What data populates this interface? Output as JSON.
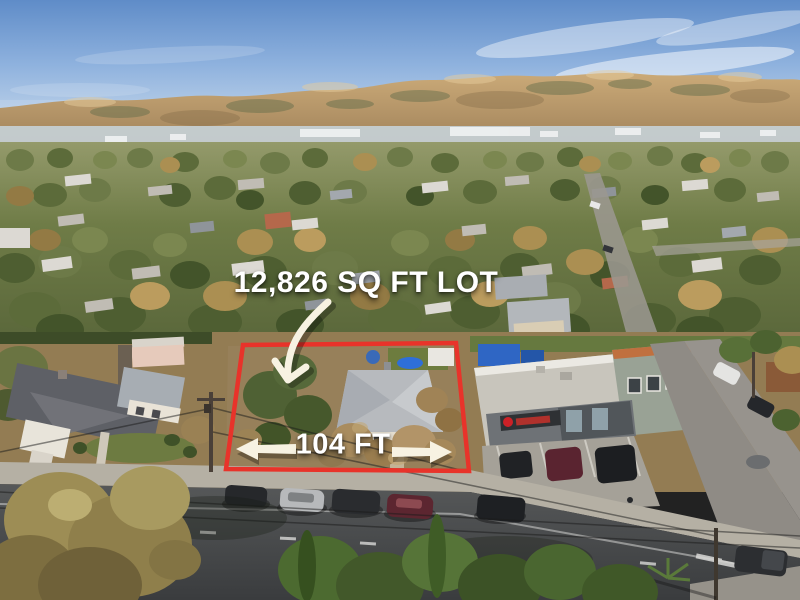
{
  "annotations": {
    "lot_size_label": "12,826 SQ FT LOT",
    "width_label": "104 FT",
    "boundary_color": "#e8332a",
    "label_color": "#ffffff",
    "arrow_color": "#f7f2e2"
  }
}
